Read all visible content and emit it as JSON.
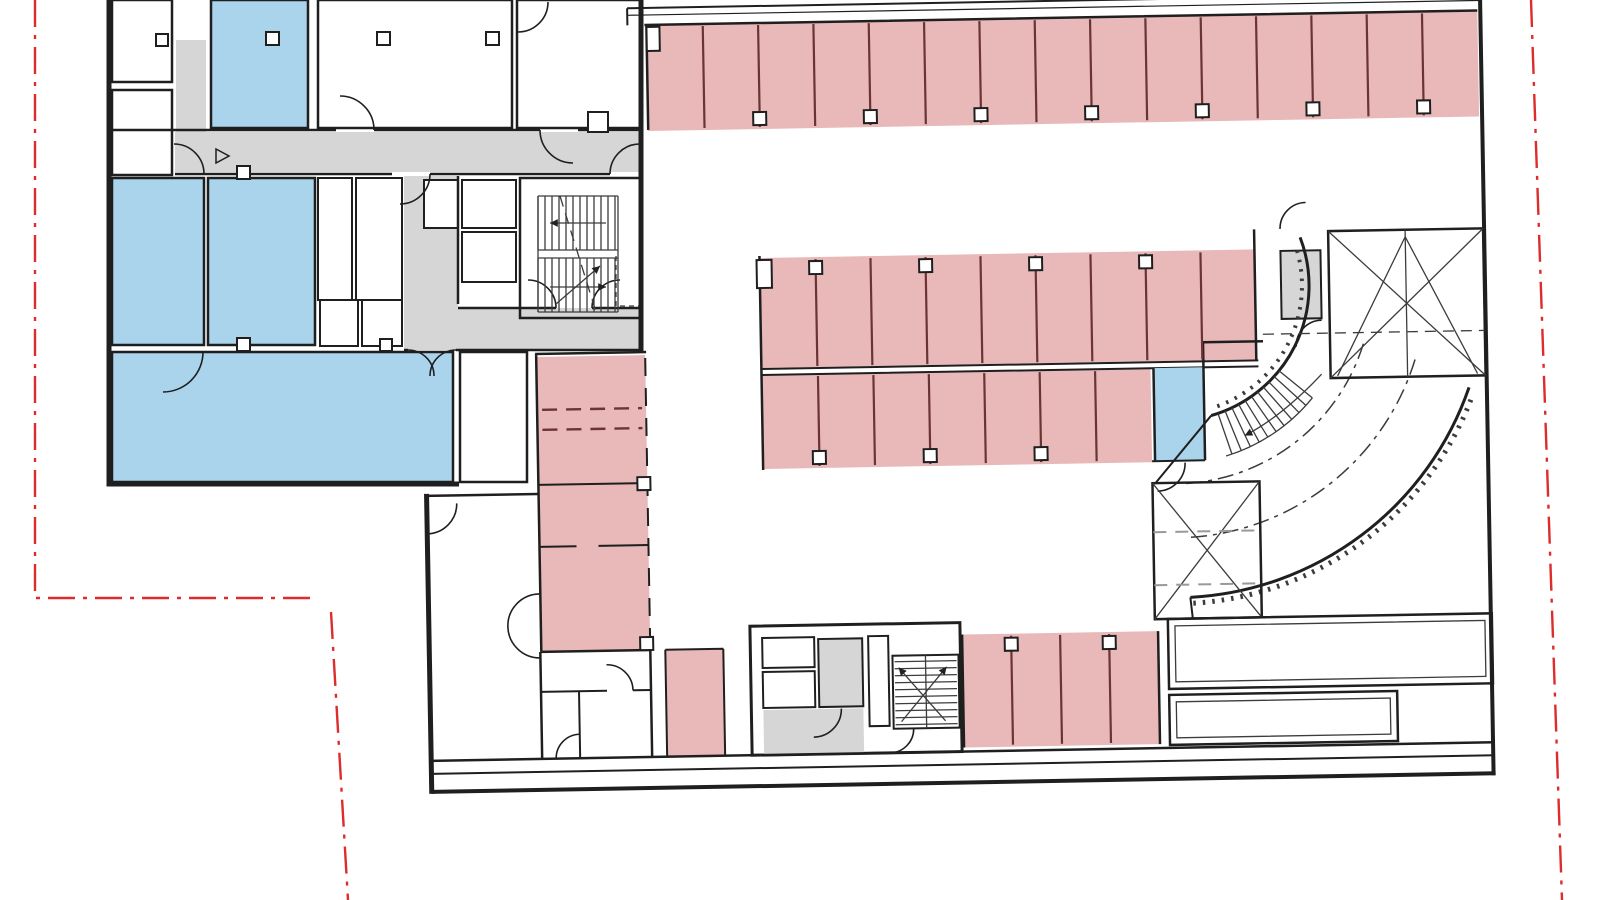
{
  "document": {
    "kind": "architectural floor plan",
    "level": "underground parking and basement level",
    "visible_text": []
  },
  "palette": {
    "wall": "#1f1f1f",
    "thin": "#3c3c3c",
    "parking_fill": "#e9b8b8",
    "stall_divider": "#6b3434",
    "room_fill": "#a9d4ec",
    "circulation_fill": "#d6d6d6",
    "dash_gray": "#999999",
    "boundary": "#dd2c2c",
    "background": "#ffffff"
  },
  "parking": {
    "top_row_stalls": 15,
    "middle_upper_stalls": 9,
    "middle_lower_stalls": 7,
    "west_column_stalls": 4,
    "bottom_row_stalls": 4,
    "single_stalls": 1,
    "blue_stalls": 1
  },
  "rooms": {
    "blue_rooms": 4,
    "stair_cores": 3,
    "shafts": 1
  },
  "site": {
    "boundary_style": "dash-dot",
    "boundary_sides": [
      "left",
      "bottom-left",
      "right"
    ]
  }
}
